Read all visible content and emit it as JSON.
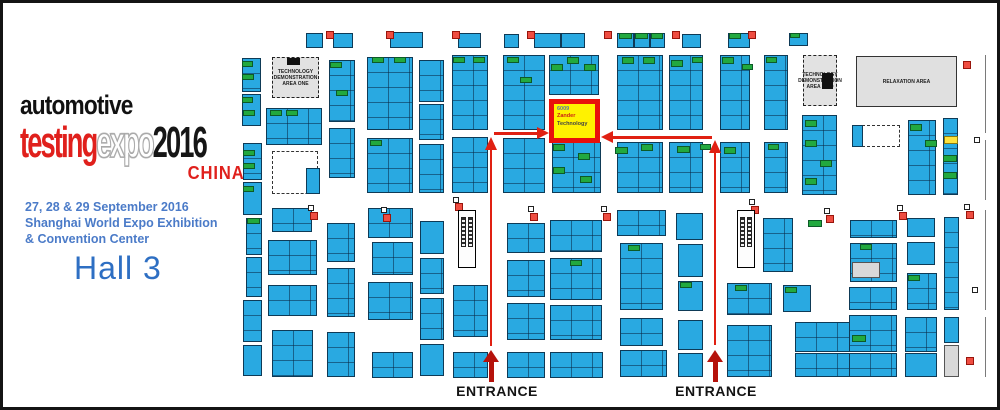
{
  "branding": {
    "automotive": "automotive",
    "testing": "testing",
    "expo": "expo",
    "year": "2016",
    "china": "CHINA"
  },
  "event": {
    "dates_line1": "27, 28 & 29 September 2016",
    "dates_line2": "Shanghai World Expo Exhibition",
    "dates_line3": "& Convention Center",
    "hall": "Hall 3"
  },
  "labels": {
    "entrance": "ENTRANCE",
    "tech_area_one": "TECHNOLOGY DEMONSTRATION AREA ONE",
    "tech_area_two": "TECHNOLOGY DEMONSTRATION AREA TWO",
    "relaxation": "RELAXATION AREA"
  },
  "highlight_booth": {
    "lines": [
      "6009",
      "Zander",
      "Technology"
    ]
  },
  "colors": {
    "booth_blue": "#29a9e1",
    "booth_green": "#22a93f",
    "highlight_yellow": "#fff200",
    "highlight_red": "#e8100c",
    "arrow_red": "#e02012",
    "pillar_red": "#ef4d41",
    "area_gray": "#e0e0e0",
    "logo_red": "#e0201c",
    "dates_blue": "#4b7bc8",
    "hall_blue": "#2e6fc3"
  },
  "plan": {
    "blocks": [
      [
        306,
        33,
        17,
        15,
        "b"
      ],
      [
        333,
        33,
        20,
        15,
        "b"
      ],
      [
        390,
        32,
        33,
        16,
        "b"
      ],
      [
        458,
        33,
        23,
        15,
        "b"
      ],
      [
        504,
        34,
        15,
        14,
        "b"
      ],
      [
        534,
        33,
        27,
        15,
        "b"
      ],
      [
        561,
        33,
        24,
        15,
        "b"
      ],
      [
        617,
        33,
        17,
        15,
        "b"
      ],
      [
        634,
        33,
        16,
        15,
        "b"
      ],
      [
        650,
        33,
        15,
        15,
        "b"
      ],
      [
        682,
        34,
        19,
        14,
        "b"
      ],
      [
        728,
        33,
        22,
        15,
        "b"
      ],
      [
        789,
        33,
        19,
        13,
        "b"
      ],
      [
        242,
        58,
        19,
        34,
        "b"
      ],
      [
        242,
        94,
        19,
        32,
        "b"
      ],
      [
        243,
        143,
        19,
        37,
        "b"
      ],
      [
        243,
        182,
        19,
        33,
        "b"
      ],
      [
        246,
        218,
        16,
        37,
        "b"
      ],
      [
        246,
        257,
        16,
        40,
        "b"
      ],
      [
        243,
        300,
        19,
        42,
        "b"
      ],
      [
        243,
        345,
        19,
        31,
        "b"
      ],
      [
        266,
        108,
        56,
        37,
        "b"
      ],
      [
        272,
        151,
        46,
        43,
        "w"
      ],
      [
        306,
        168,
        14,
        26,
        "b"
      ],
      [
        272,
        208,
        40,
        24,
        "b"
      ],
      [
        268,
        240,
        49,
        35,
        "b"
      ],
      [
        268,
        285,
        49,
        31,
        "b"
      ],
      [
        272,
        330,
        41,
        47,
        "b"
      ],
      [
        329,
        60,
        26,
        62,
        "b"
      ],
      [
        329,
        128,
        26,
        50,
        "b"
      ],
      [
        327,
        223,
        28,
        39,
        "b"
      ],
      [
        327,
        268,
        28,
        49,
        "b"
      ],
      [
        327,
        332,
        28,
        45,
        "b"
      ],
      [
        367,
        57,
        46,
        73,
        "b"
      ],
      [
        367,
        138,
        46,
        55,
        "b"
      ],
      [
        368,
        208,
        45,
        30,
        "b"
      ],
      [
        372,
        242,
        41,
        33,
        "b"
      ],
      [
        368,
        282,
        45,
        38,
        "b"
      ],
      [
        372,
        352,
        41,
        26,
        "b"
      ],
      [
        419,
        60,
        25,
        42,
        "b"
      ],
      [
        419,
        104,
        25,
        36,
        "b"
      ],
      [
        419,
        144,
        25,
        49,
        "b"
      ],
      [
        420,
        221,
        24,
        33,
        "b"
      ],
      [
        420,
        258,
        24,
        36,
        "b"
      ],
      [
        420,
        298,
        24,
        42,
        "b"
      ],
      [
        420,
        344,
        24,
        32,
        "b"
      ],
      [
        452,
        55,
        36,
        75,
        "b"
      ],
      [
        452,
        137,
        36,
        56,
        "b"
      ],
      [
        453,
        285,
        35,
        52,
        "b"
      ],
      [
        453,
        352,
        35,
        26,
        "b"
      ],
      [
        503,
        55,
        42,
        75,
        "b"
      ],
      [
        503,
        138,
        42,
        55,
        "b"
      ],
      [
        507,
        223,
        38,
        30,
        "b"
      ],
      [
        507,
        260,
        38,
        37,
        "b"
      ],
      [
        507,
        303,
        38,
        37,
        "b"
      ],
      [
        507,
        352,
        38,
        26,
        "b"
      ],
      [
        549,
        55,
        50,
        40,
        "b"
      ],
      [
        552,
        142,
        49,
        51,
        "b"
      ],
      [
        550,
        220,
        52,
        32,
        "b"
      ],
      [
        550,
        258,
        52,
        42,
        "b"
      ],
      [
        550,
        305,
        52,
        35,
        "b"
      ],
      [
        550,
        352,
        53,
        26,
        "b"
      ],
      [
        617,
        55,
        46,
        75,
        "b"
      ],
      [
        617,
        142,
        46,
        51,
        "b"
      ],
      [
        617,
        210,
        49,
        26,
        "b"
      ],
      [
        620,
        243,
        43,
        67,
        "b"
      ],
      [
        620,
        318,
        43,
        28,
        "b"
      ],
      [
        620,
        350,
        47,
        27,
        "b"
      ],
      [
        669,
        55,
        34,
        75,
        "b"
      ],
      [
        669,
        142,
        34,
        51,
        "b"
      ],
      [
        676,
        213,
        27,
        27,
        "b"
      ],
      [
        678,
        244,
        25,
        33,
        "b"
      ],
      [
        678,
        281,
        25,
        30,
        "b"
      ],
      [
        678,
        320,
        25,
        30,
        "b"
      ],
      [
        678,
        353,
        25,
        24,
        "b"
      ],
      [
        720,
        55,
        30,
        75,
        "b"
      ],
      [
        720,
        142,
        30,
        51,
        "b"
      ],
      [
        727,
        283,
        45,
        32,
        "b"
      ],
      [
        727,
        325,
        45,
        52,
        "b"
      ],
      [
        764,
        55,
        24,
        75,
        "b"
      ],
      [
        764,
        142,
        24,
        51,
        "b"
      ],
      [
        763,
        218,
        30,
        54,
        "b"
      ],
      [
        783,
        285,
        28,
        27,
        "b"
      ],
      [
        802,
        115,
        35,
        80,
        "b"
      ],
      [
        795,
        322,
        58,
        30,
        "b"
      ],
      [
        795,
        353,
        58,
        24,
        "b"
      ],
      [
        852,
        125,
        48,
        22,
        "w"
      ],
      [
        852,
        125,
        11,
        22,
        "b"
      ],
      [
        850,
        220,
        47,
        18,
        "b"
      ],
      [
        850,
        243,
        47,
        39,
        "b"
      ],
      [
        852,
        262,
        28,
        16,
        "gy"
      ],
      [
        849,
        287,
        48,
        23,
        "b"
      ],
      [
        849,
        315,
        48,
        37,
        "b"
      ],
      [
        849,
        353,
        48,
        24,
        "b"
      ],
      [
        908,
        120,
        28,
        75,
        "b"
      ],
      [
        907,
        218,
        28,
        19,
        "b"
      ],
      [
        907,
        242,
        28,
        23,
        "b"
      ],
      [
        907,
        273,
        30,
        37,
        "b"
      ],
      [
        905,
        317,
        32,
        35,
        "b"
      ],
      [
        905,
        353,
        32,
        24,
        "b"
      ],
      [
        943,
        118,
        15,
        77,
        "b"
      ],
      [
        944,
        136,
        14,
        8,
        "gd"
      ],
      [
        944,
        217,
        15,
        93,
        "b"
      ],
      [
        944,
        317,
        15,
        26,
        "b"
      ],
      [
        944,
        345,
        15,
        32,
        "gy"
      ]
    ],
    "greens": [
      [
        619,
        33,
        13,
        6
      ],
      [
        635,
        33,
        13,
        6
      ],
      [
        651,
        33,
        12,
        6
      ],
      [
        729,
        33,
        12,
        6
      ],
      [
        790,
        33,
        10,
        5
      ],
      [
        242,
        61,
        11,
        6
      ],
      [
        242,
        74,
        12,
        6
      ],
      [
        242,
        97,
        11,
        6
      ],
      [
        243,
        110,
        12,
        6
      ],
      [
        243,
        150,
        12,
        6
      ],
      [
        243,
        163,
        12,
        6
      ],
      [
        243,
        186,
        11,
        6
      ],
      [
        247,
        218,
        13,
        6
      ],
      [
        270,
        110,
        12,
        6
      ],
      [
        286,
        110,
        12,
        6
      ],
      [
        330,
        62,
        12,
        6
      ],
      [
        336,
        90,
        12,
        6
      ],
      [
        372,
        57,
        12,
        6
      ],
      [
        394,
        57,
        12,
        6
      ],
      [
        370,
        140,
        12,
        6
      ],
      [
        453,
        57,
        12,
        6
      ],
      [
        473,
        57,
        12,
        6
      ],
      [
        507,
        57,
        12,
        6
      ],
      [
        520,
        77,
        12,
        6
      ],
      [
        551,
        64,
        12,
        7
      ],
      [
        567,
        57,
        12,
        7
      ],
      [
        584,
        64,
        12,
        7
      ],
      [
        553,
        144,
        12,
        7
      ],
      [
        578,
        153,
        12,
        7
      ],
      [
        553,
        167,
        12,
        7
      ],
      [
        580,
        176,
        12,
        7
      ],
      [
        622,
        57,
        12,
        7
      ],
      [
        643,
        57,
        12,
        7
      ],
      [
        671,
        60,
        12,
        7
      ],
      [
        692,
        57,
        11,
        6
      ],
      [
        722,
        57,
        12,
        7
      ],
      [
        742,
        64,
        11,
        6
      ],
      [
        766,
        57,
        11,
        6
      ],
      [
        615,
        147,
        13,
        7
      ],
      [
        641,
        144,
        12,
        7
      ],
      [
        677,
        146,
        13,
        7
      ],
      [
        700,
        144,
        11,
        6
      ],
      [
        724,
        147,
        12,
        7
      ],
      [
        768,
        144,
        11,
        6
      ],
      [
        805,
        120,
        12,
        7
      ],
      [
        805,
        140,
        12,
        7
      ],
      [
        820,
        160,
        12,
        7
      ],
      [
        805,
        178,
        12,
        7
      ],
      [
        910,
        124,
        12,
        7
      ],
      [
        925,
        140,
        12,
        7
      ],
      [
        943,
        155,
        14,
        7
      ],
      [
        943,
        172,
        14,
        7
      ],
      [
        808,
        220,
        14,
        7
      ],
      [
        852,
        335,
        14,
        7
      ],
      [
        680,
        282,
        12,
        6
      ],
      [
        628,
        245,
        12,
        6
      ],
      [
        570,
        260,
        12,
        6
      ],
      [
        735,
        285,
        12,
        6
      ],
      [
        785,
        287,
        12,
        6
      ],
      [
        860,
        244,
        12,
        6
      ],
      [
        908,
        275,
        12,
        6
      ]
    ],
    "pillars": [
      [
        326,
        31
      ],
      [
        386,
        31
      ],
      [
        452,
        31
      ],
      [
        527,
        31
      ],
      [
        604,
        31
      ],
      [
        672,
        31
      ],
      [
        748,
        31
      ],
      [
        963,
        61
      ],
      [
        310,
        212
      ],
      [
        383,
        214
      ],
      [
        455,
        203
      ],
      [
        530,
        213
      ],
      [
        603,
        213
      ],
      [
        751,
        206
      ],
      [
        826,
        215
      ],
      [
        899,
        212
      ],
      [
        966,
        211
      ],
      [
        966,
        357
      ]
    ],
    "white_squares": [
      [
        308,
        205
      ],
      [
        381,
        207
      ],
      [
        453,
        197
      ],
      [
        528,
        206
      ],
      [
        601,
        206
      ],
      [
        749,
        199
      ],
      [
        824,
        208
      ],
      [
        897,
        205
      ],
      [
        964,
        204
      ],
      [
        972,
        287
      ],
      [
        974,
        137
      ]
    ],
    "walls": [
      [
        985,
        55,
        78
      ],
      [
        985,
        140,
        60
      ],
      [
        985,
        210,
        100
      ],
      [
        985,
        317,
        60
      ]
    ],
    "escalators": [
      [
        458,
        210,
        18,
        58
      ],
      [
        737,
        210,
        18,
        58
      ]
    ]
  }
}
